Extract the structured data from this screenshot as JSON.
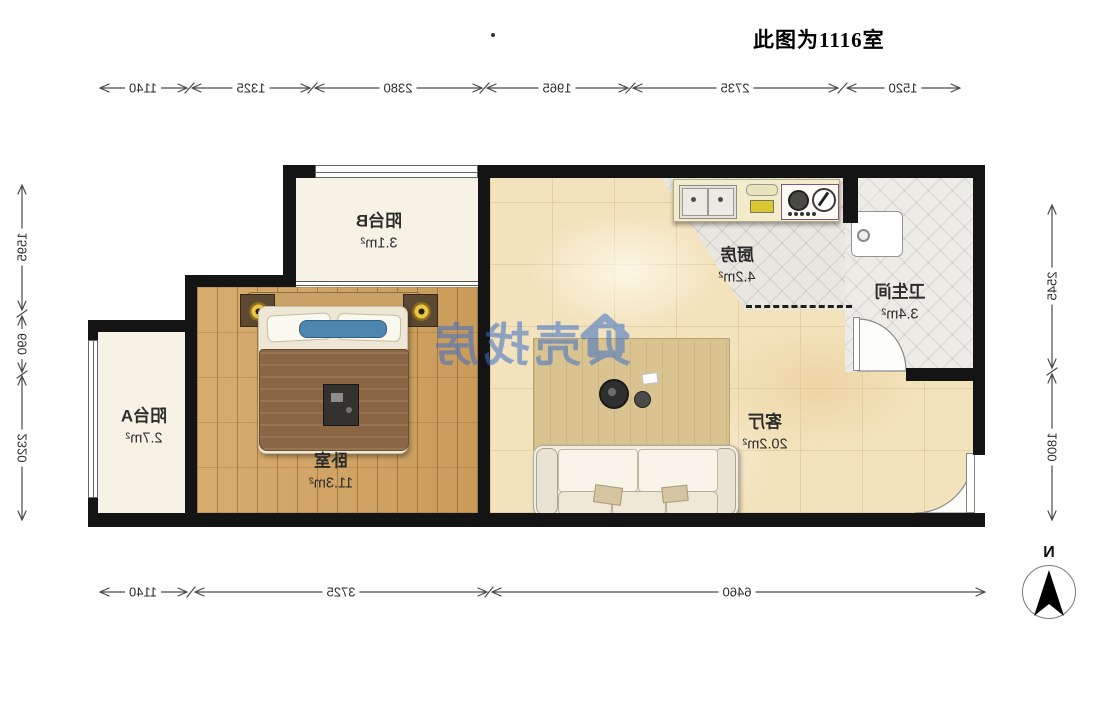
{
  "title": "此图为1116室",
  "rooms": {
    "balcony_b": {
      "name": "阳台B",
      "area": "3.1m²"
    },
    "bedroom": {
      "name": "卧室",
      "area": "11.3m²"
    },
    "balcony_a": {
      "name": "阳台A",
      "area": "2.7m²"
    },
    "kitchen": {
      "name": "厨房",
      "area": "4.2m²"
    },
    "bathroom": {
      "name": "卫生间",
      "area": "3.4m²"
    },
    "living": {
      "name": "客厅",
      "area": "20.2m²"
    }
  },
  "dimensions": {
    "top": [
      "1140",
      "1325",
      "2380",
      "1965",
      "2735",
      "1520"
    ],
    "bottom": [
      "1140",
      "3725",
      "6460"
    ],
    "left": [
      "1595",
      "690",
      "2320"
    ],
    "right": [
      "2545",
      "1800"
    ]
  },
  "watermark": {
    "text": "贝壳找房"
  },
  "compass": {
    "label": "N"
  },
  "colors": {
    "wall": "#141414",
    "wood_floor": "#d0a361",
    "living_tile": "#f3e3bd",
    "balcony_floor": "#f6f3e6",
    "kitchen_tile": "#e9e7e0",
    "watermark_blue": "#3d6fc9",
    "counter_yellow": "#f2ecca",
    "accent_pillow_blue": "#4d87b0"
  },
  "note": "plan rendered mirrored (scaleX(-1) text)"
}
